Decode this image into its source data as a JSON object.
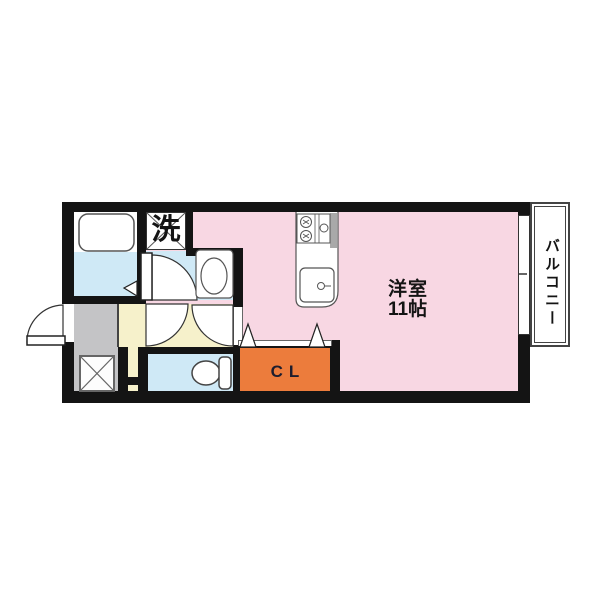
{
  "floorplan": {
    "rooms": {
      "main": {
        "name": "洋室",
        "size": "11帖",
        "color": "#f8d7e3"
      },
      "laundry": {
        "label": "洗",
        "color": "#ffffff"
      },
      "closet": {
        "label": "CL",
        "color": "#ec7c3c"
      },
      "balcony": {
        "label": "バルコニー",
        "color": "#ffffff"
      },
      "bathroom": {
        "color": "#cfe9f6"
      },
      "washroom": {
        "color": "#cfe9f6"
      },
      "toilet": {
        "color": "#cfe9f6"
      },
      "hallway": {
        "color": "#f6f1cb"
      },
      "entrance": {
        "color": "#c4c4c6"
      }
    },
    "colors": {
      "wall": "#141414",
      "fixture_stroke": "#555555",
      "background": "#ffffff"
    }
  }
}
